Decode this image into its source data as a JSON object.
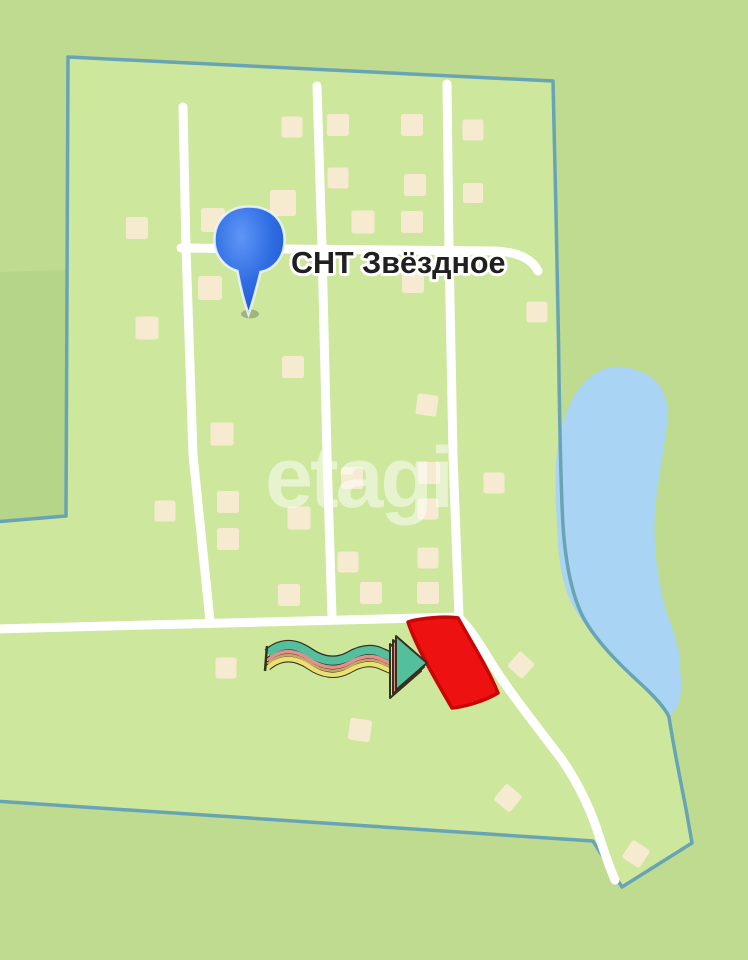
{
  "map": {
    "title_label": "СНТ Звёздное",
    "watermark": "etagi",
    "colors": {
      "outside": "#bedb90",
      "inside": "#cde79d",
      "forest": "#b5d588",
      "border": "#68a4b4",
      "lake": "#a9d4f3",
      "road": "#ffffff",
      "house": "#f6ebd1",
      "plot_fill": "#ee1111",
      "plot_stroke": "#c90505",
      "pin_light": "#5e96f7",
      "pin_main": "#2f6ce2",
      "pin_dark": "#2257cd",
      "label_text": "#202020",
      "label_halo": "#ffffff",
      "watermark_color": "rgba(255,255,255,0.5)",
      "arrow_teal": "#54bf9d",
      "arrow_pink": "#e2908e",
      "arrow_tan": "#c9a469",
      "arrow_yellow": "#eae173",
      "arrow_outline": "#35311e"
    },
    "houses": [
      [
        292,
        127,
        21,
        0
      ],
      [
        338,
        125,
        22,
        0
      ],
      [
        412,
        125,
        22,
        0
      ],
      [
        473,
        130,
        21,
        0
      ],
      [
        338,
        178,
        21,
        0
      ],
      [
        415,
        185,
        22,
        0
      ],
      [
        473,
        193,
        20,
        0
      ],
      [
        283,
        203,
        26,
        0
      ],
      [
        137,
        228,
        22,
        0
      ],
      [
        213,
        220,
        24,
        0
      ],
      [
        363,
        222,
        23,
        0
      ],
      [
        412,
        222,
        22,
        0
      ],
      [
        210,
        288,
        24,
        0
      ],
      [
        413,
        282,
        22,
        0
      ],
      [
        147,
        328,
        23,
        0
      ],
      [
        537,
        312,
        21,
        0
      ],
      [
        293,
        367,
        22,
        0
      ],
      [
        222,
        434,
        23,
        0
      ],
      [
        165,
        511,
        21,
        0
      ],
      [
        228,
        502,
        22,
        0
      ],
      [
        228,
        539,
        22,
        0
      ],
      [
        299,
        518,
        23,
        0
      ],
      [
        289,
        595,
        22,
        0
      ],
      [
        352,
        478,
        22,
        0
      ],
      [
        427,
        405,
        21,
        8
      ],
      [
        429,
        473,
        22,
        0
      ],
      [
        428,
        509,
        21,
        0
      ],
      [
        348,
        562,
        21,
        0
      ],
      [
        371,
        593,
        22,
        0
      ],
      [
        428,
        558,
        21,
        0
      ],
      [
        428,
        593,
        22,
        0
      ],
      [
        494,
        483,
        21,
        0
      ],
      [
        226,
        668,
        21,
        0
      ],
      [
        360,
        730,
        22,
        8
      ],
      [
        508,
        798,
        21,
        40
      ],
      [
        521,
        665,
        20,
        42
      ],
      [
        636,
        854,
        21,
        33
      ]
    ]
  }
}
